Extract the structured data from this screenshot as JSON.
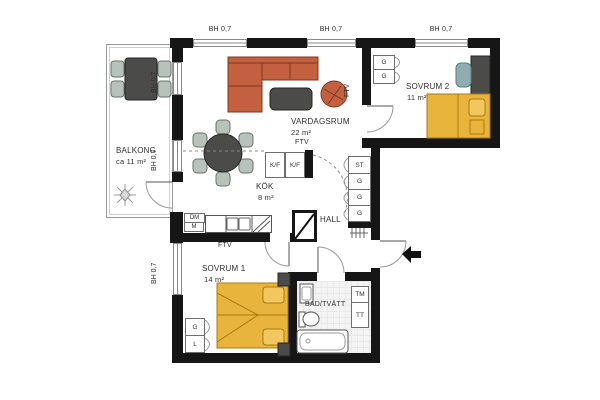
{
  "plan": {
    "window_label": "BH 0,7",
    "tv_outlet_label": "FTV",
    "rooms": {
      "vardagsrum": {
        "name": "VARDAGSRUM",
        "area": "22 m²"
      },
      "kok": {
        "name": "KÖK",
        "area": "8 m²"
      },
      "hall": {
        "name": "HALL"
      },
      "sovrum1": {
        "name": "SOVRUM 1",
        "area": "14 m²"
      },
      "sovrum2": {
        "name": "SOVRUM 2",
        "area": "11 m²"
      },
      "bad_tvatt": {
        "name": "BAD/TVÄTT"
      },
      "balkong": {
        "name": "BALKONG",
        "area": "ca 11 m²"
      }
    },
    "fixtures": {
      "hall_closets": [
        "ST",
        "G",
        "G",
        "G"
      ],
      "sovrum2_closets": [
        "G",
        "G"
      ],
      "sovrum1_closets": [
        "G",
        "L"
      ],
      "kitchen_appliances": {
        "fridge_freezer_1": "K/F",
        "fridge_freezer_2": "K/F",
        "dishwasher": "DM",
        "microwave": "M"
      },
      "laundry": {
        "washing_machine": "TM",
        "dryer": "TT"
      }
    },
    "colors": {
      "wall": "#161616",
      "bed_yellow": "#e9b43c",
      "sofa_terracotta": "#c2603f",
      "furniture_dark": "#4b4b49",
      "chair_sage": "#b7c2ba",
      "desk_chair_teal": "#8fadb0"
    }
  }
}
